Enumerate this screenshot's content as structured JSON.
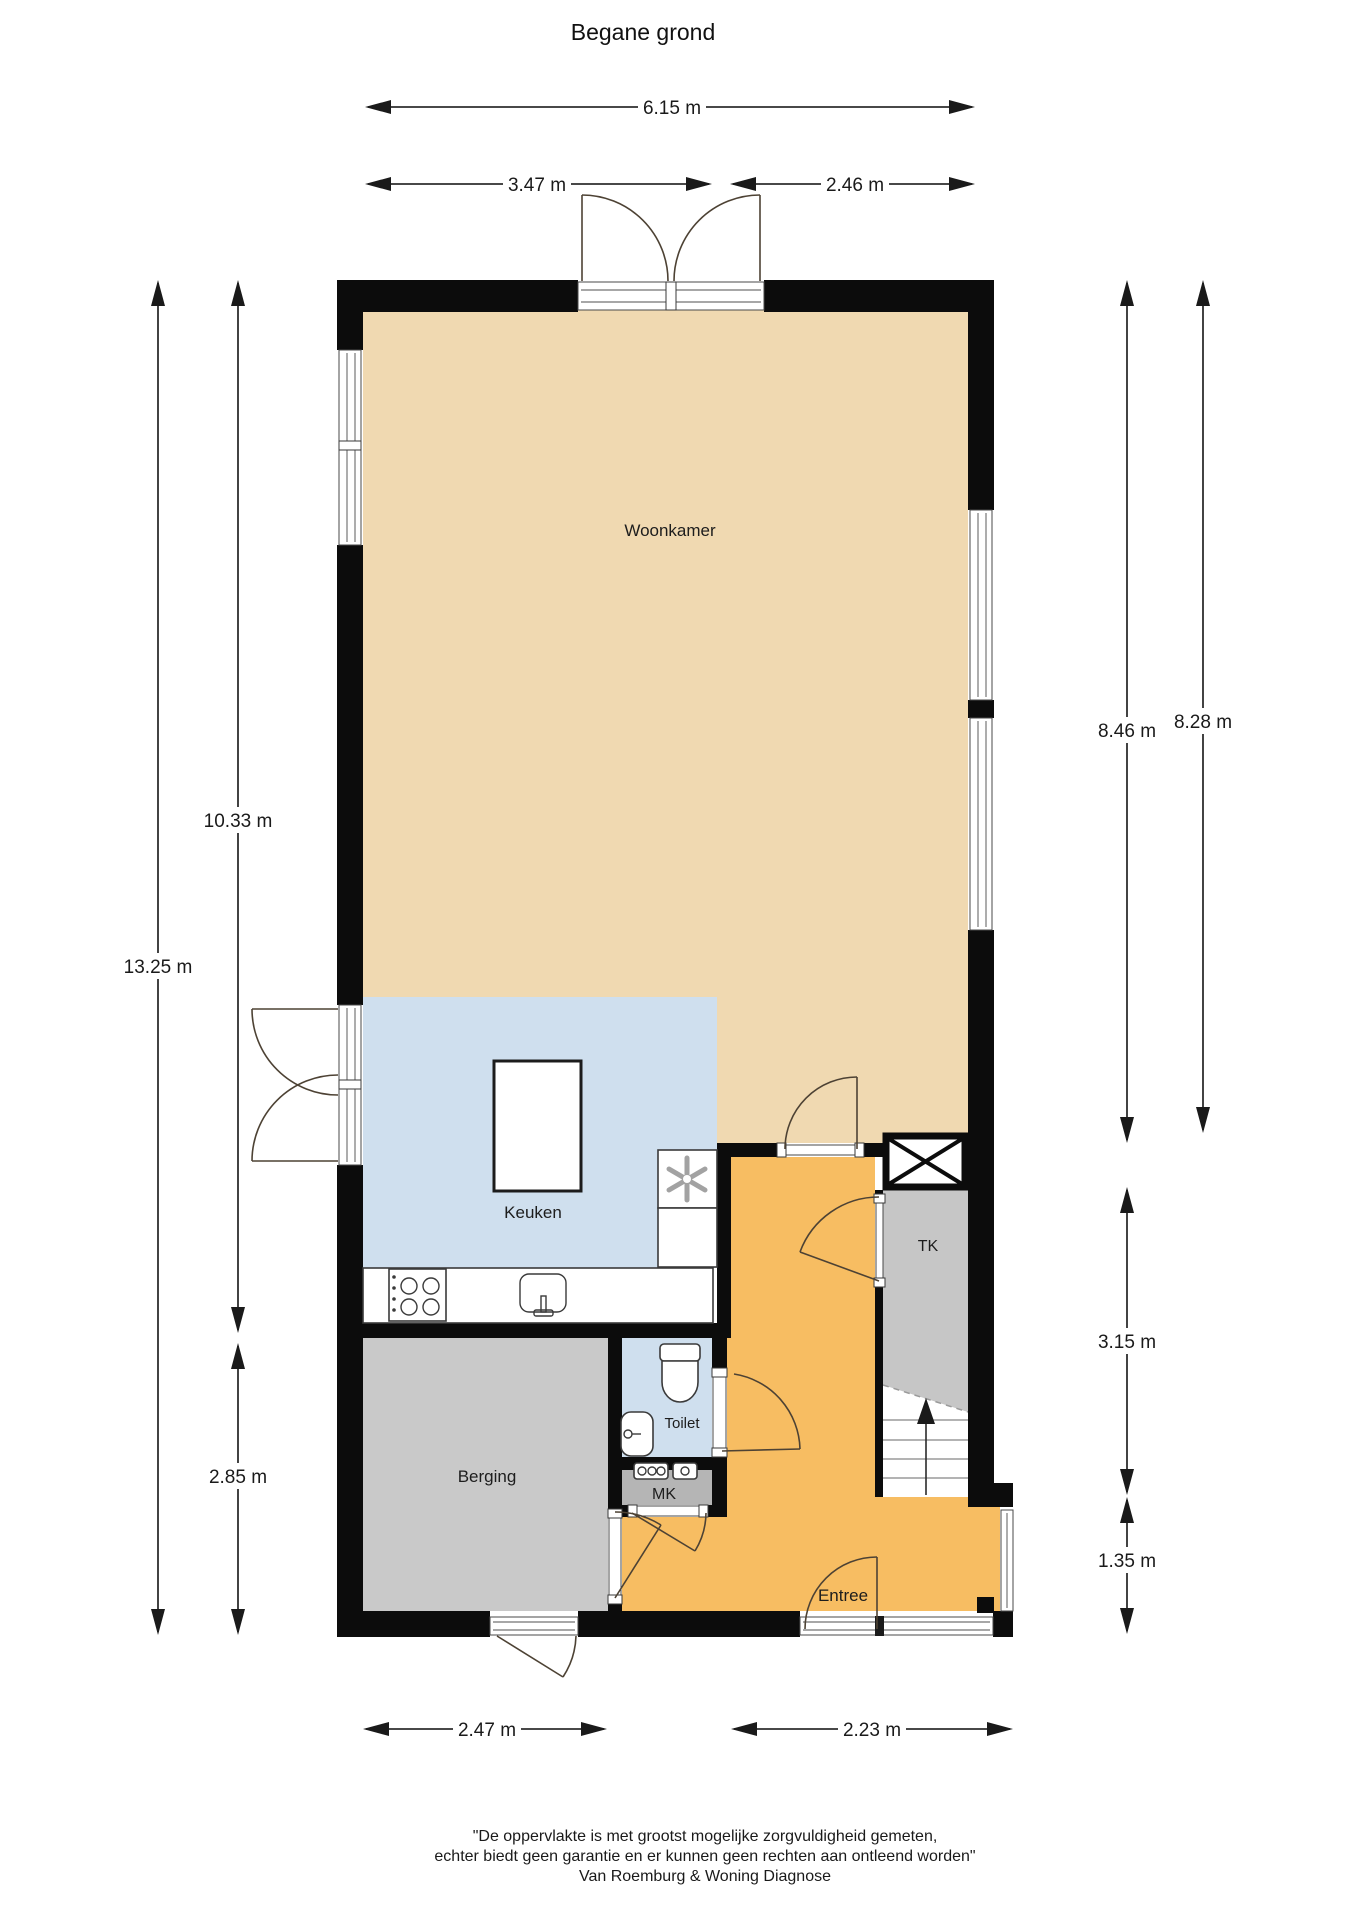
{
  "title": "Begane grond",
  "floor_plan": {
    "rooms": {
      "woonkamer": {
        "label": "Woonkamer"
      },
      "keuken": {
        "label": "Keuken"
      },
      "berging": {
        "label": "Berging"
      },
      "toilet": {
        "label": "Toilet"
      },
      "mk": {
        "label": "MK"
      },
      "tk": {
        "label": "TK"
      },
      "entree": {
        "label": "Entree"
      }
    },
    "colors": {
      "woonkamer": "#f0d9b1",
      "keuken": "#cfdfee",
      "toilet": "#cfdfee",
      "entree": "#f7bd62",
      "berging": "#c9c9c9",
      "mk": "#b5b5b5",
      "tk": "#c6c6c6",
      "wall": "#0c0c0c"
    }
  },
  "dimensions": {
    "top_total": {
      "label": "6.15 m"
    },
    "top_left": {
      "label": "3.47 m"
    },
    "top_right": {
      "label": "2.46 m"
    },
    "left_total": {
      "label": "13.25 m"
    },
    "left_upper": {
      "label": "10.33 m"
    },
    "left_lower": {
      "label": "2.85 m"
    },
    "right_inner": {
      "label": "8.46 m"
    },
    "right_outer": {
      "label": "8.28 m"
    },
    "right_tk": {
      "label": "3.15 m"
    },
    "right_entree": {
      "label": "1.35 m"
    },
    "bottom_left": {
      "label": "2.47 m"
    },
    "bottom_right": {
      "label": "2.23 m"
    }
  },
  "footer": {
    "line1": "\"De oppervlakte is met grootst mogelijke zorgvuldigheid gemeten,",
    "line2": "echter biedt geen garantie en er kunnen geen rechten aan ontleend worden\"",
    "line3": "Van Roemburg & Woning Diagnose"
  }
}
